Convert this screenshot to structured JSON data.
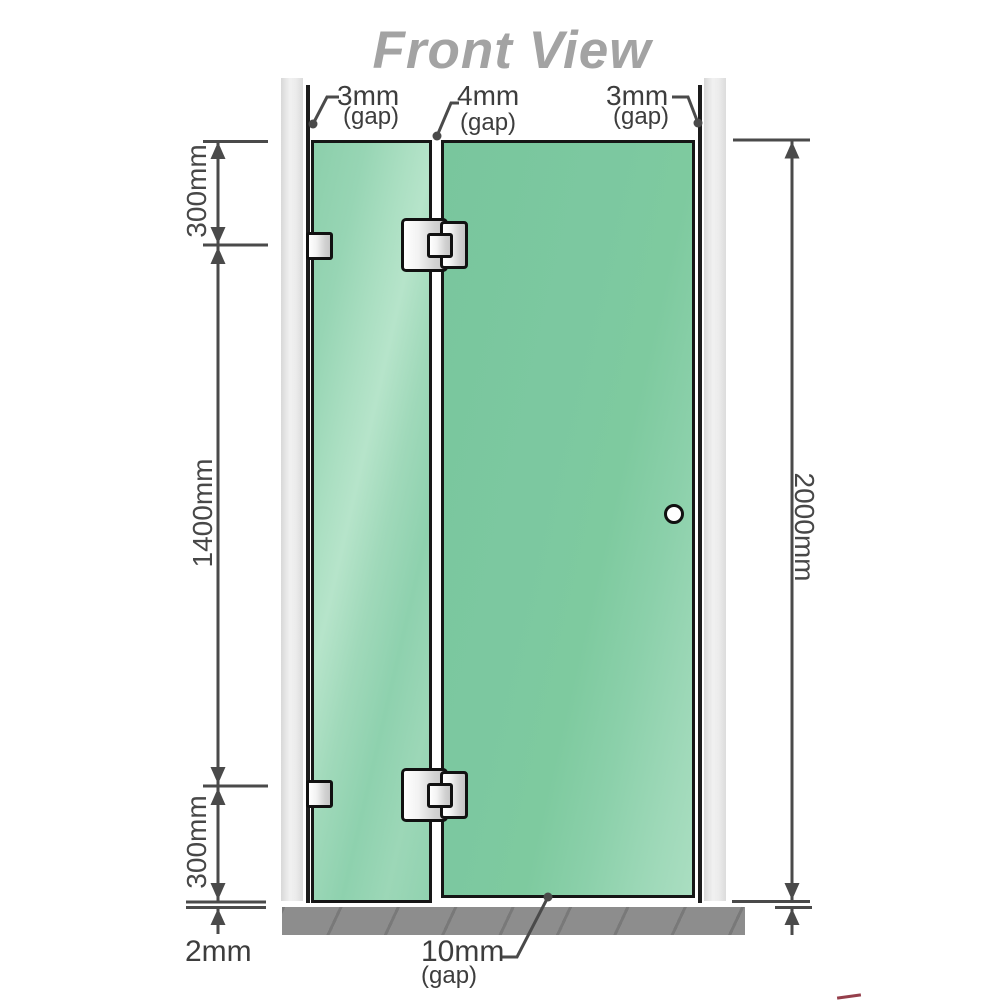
{
  "title": "Front View",
  "colors": {
    "glass_green": "#7cc8a0",
    "glass_green_light": "#b4e3c9",
    "wall_gray": "#e8e8e8",
    "floor_gray": "#8d8d8d",
    "outline_dark": "#161616",
    "dimension_gray": "#4a4a4a",
    "title_gray": "#a3a3a3"
  },
  "gaps": {
    "left": {
      "value": "3mm",
      "suffix": "(gap)"
    },
    "middle": {
      "value": "4mm",
      "suffix": "(gap)"
    },
    "right": {
      "value": "3mm",
      "suffix": "(gap)"
    },
    "bottom": {
      "value": "10mm",
      "suffix": "(gap)"
    },
    "floor": {
      "value": "2mm"
    }
  },
  "dimensions": {
    "top": "300mm",
    "middle": "1400mm",
    "bottom": "300mm",
    "overall": "2000mm"
  }
}
